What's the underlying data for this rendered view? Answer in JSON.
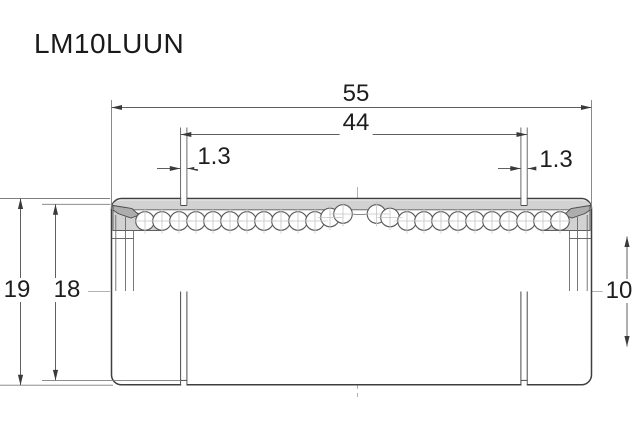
{
  "title": "LM10LUUN",
  "dimensions": {
    "overall_length": "55",
    "between_grooves": "44",
    "groove_width_left": "1.3",
    "groove_width_right": "1.3",
    "outer_diameter": "19",
    "groove_outer_diameter": "18",
    "bore_diameter": "10"
  },
  "colors": {
    "outline": "#3f3f3f",
    "shell_fill": "#d2d2d2",
    "seal_fill": "#adadad",
    "centerline": "#b2b2b2",
    "background": "#ffffff"
  }
}
